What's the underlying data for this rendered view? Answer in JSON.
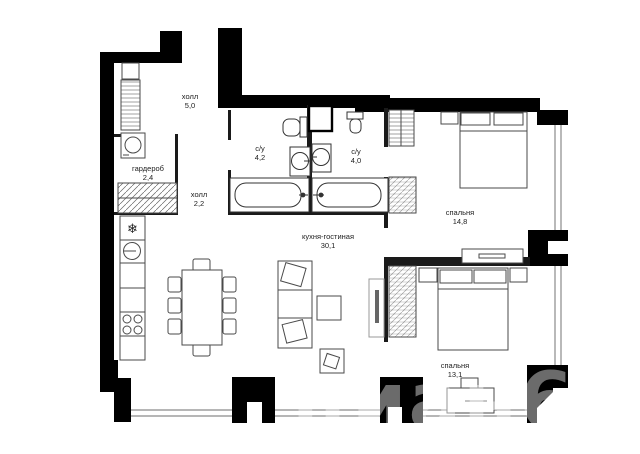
{
  "image_type": "apartment-floor-plan",
  "colors": {
    "background": "#ffffff",
    "exterior_walls": "#000000",
    "interior_walls": "#1a1a1a",
    "window_lines": "#8a8a8a",
    "furniture_stroke": "#4a4a4a",
    "label_text": "#222222"
  },
  "icons": {
    "fridge": "❄"
  },
  "watermark": "циан6",
  "rooms": [
    {
      "name": "холл",
      "area": "5,0"
    },
    {
      "name": "гардероб",
      "area": "2,4"
    },
    {
      "name": "холл",
      "area": "2,2"
    },
    {
      "name": "с/у",
      "area": "4,2"
    },
    {
      "name": "с/у",
      "area": "4,0"
    },
    {
      "name": "кухня-гостиная",
      "area": "30,1"
    },
    {
      "name": "спальня",
      "area": "14,8"
    },
    {
      "name": "спальня",
      "area": "13,1"
    }
  ]
}
